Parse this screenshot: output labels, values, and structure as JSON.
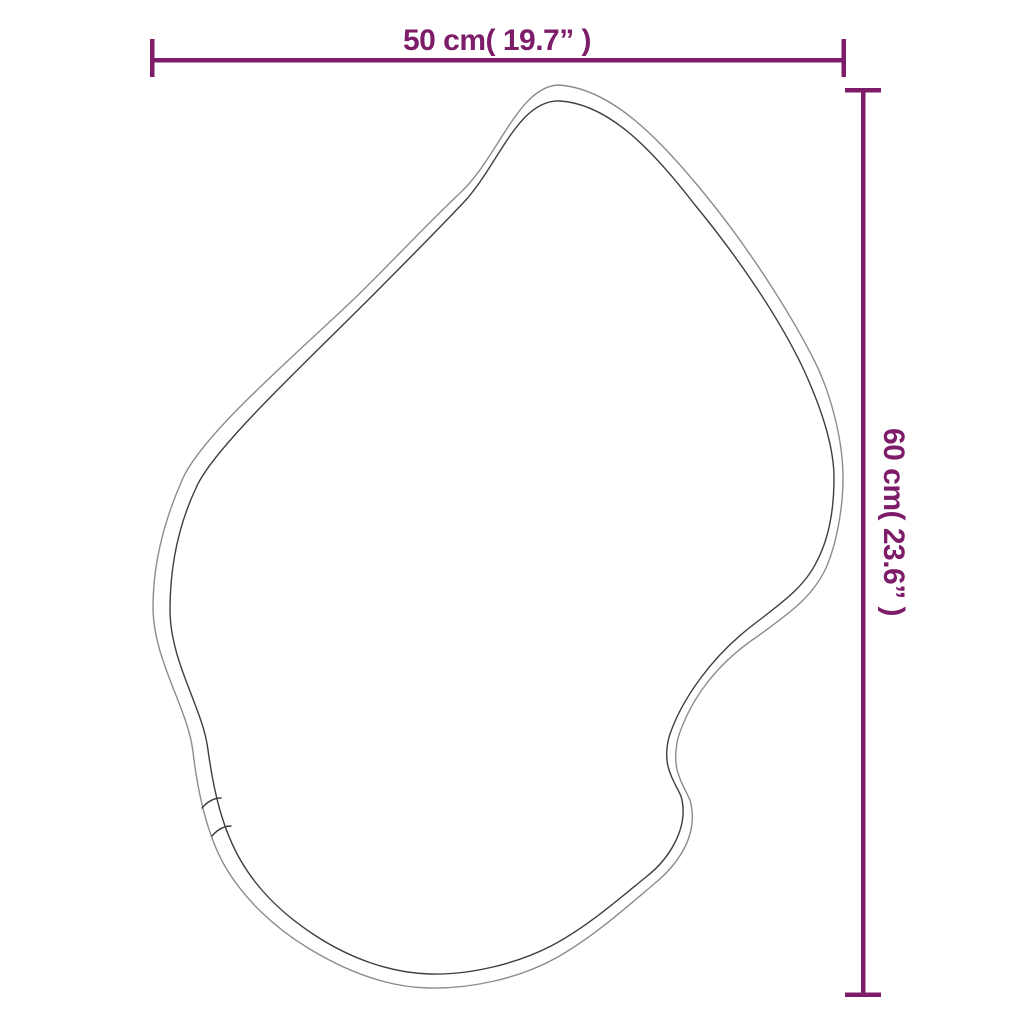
{
  "page": {
    "background_color": "#ffffff",
    "description": "Product dimension diagram of an organic blob-shaped wall mirror"
  },
  "dimensions": {
    "color": "#7d1d69",
    "width": {
      "label": "50 cm( 19.7” )",
      "value_cm": "50",
      "value_inch": "19.7"
    },
    "height": {
      "label": "60 cm( 23.6” )",
      "value_cm": "60",
      "value_inch": "23.6"
    }
  },
  "shape": {
    "name": "organic-blob-mirror-outline",
    "outer_stroke_color": "#8c8c8c",
    "inner_stroke_color": "#3e3e3e"
  }
}
